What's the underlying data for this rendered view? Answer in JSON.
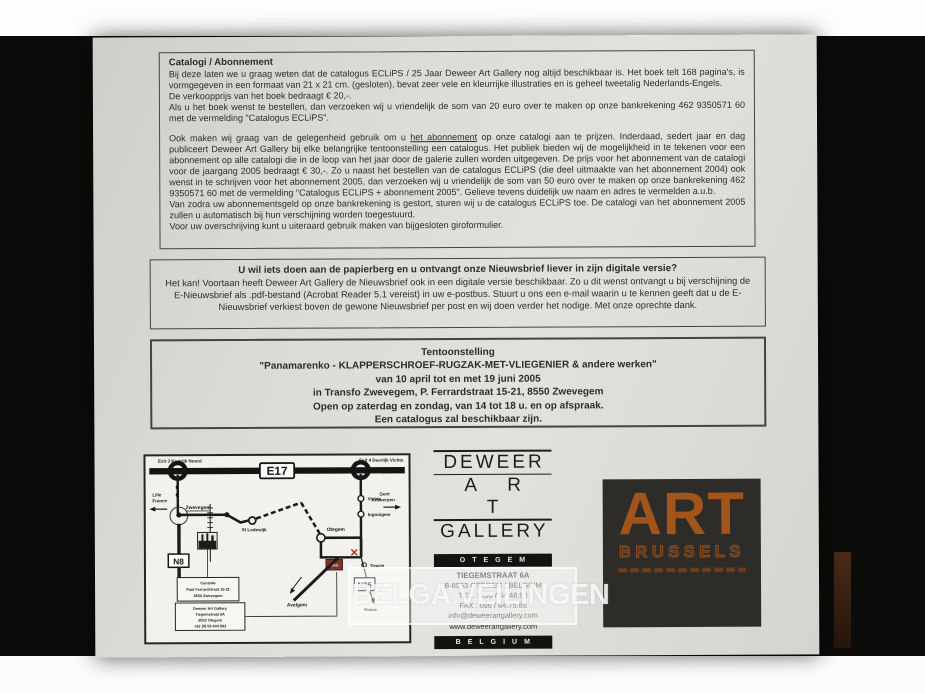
{
  "box1": {
    "heading": "Catalogi / Abonnement",
    "p1_line1": "Bij deze laten we u graag weten dat de catalogus ECLiPS / 25 Jaar Deweer Art Gallery nog altijd beschikbaar is. Het boek telt 168 pagina's, is vormgegeven in een formaat van 21 x 21 cm. (gesloten), bevat zeer vele en kleurrijke illustraties en is geheel tweetalig Nederlands-Engels.",
    "p1_line2": "De verkoopprijs van het boek bedraagt € 20,-.",
    "p1_line3": "Als u het boek wenst te bestellen, dan verzoeken wij u vriendelijk de som van 20 euro over te maken op onze bankrekening 462 9350571 60 met de vermelding \"Catalogus ECLiPS\".",
    "p2_pre": "Ook maken wij graag van de gelegenheid gebruik om u ",
    "p2_underline": "het abonnement",
    "p2_post": " op onze catalogi aan te prijzen. Inderdaad, sedert jaar en dag publiceert Deweer Art Gallery bij elke belangrijke tentoonstelling een catalogus. Het publiek bieden wij de mogelijkheid in te tekenen voor een abonnement op alle catalogi die in de loop van het jaar door de galerie zullen worden uitgegeven. De prijs voor het abonnement van de catalogi voor de jaargang 2005 bedraagt € 30,-. Zo u naast het bestellen van de catalogus ECLiPS (die deel uitmaakte van het abonnement 2004) ook wenst in te schrijven voor het abonnement 2005, dan verzoeken wij u vriendelijk de som van 50 euro over te maken op onze bankrekening 462 9350571 60 met de vermelding \"Catalogus ECLiPS + abonnement 2005\". Gelieve tevens duidelijk uw naam en adres te vermelden a.u.b.",
    "p2_line2": "Van zodra uw abonnementsgeld op onze bankrekening is gestort, sturen wij u de catalogus ECLiPS toe. De catalogi van het abonnement 2005 zullen u automatisch bij hun verschijning worden toegestuurd.",
    "p2_line3": "Voor uw overschrijving kunt u uiteraard gebruik maken van bijgesloten giroformulier."
  },
  "box2": {
    "heading": "U wil iets doen aan de papierberg en u ontvangt onze Nieuwsbrief liever in zijn digitale versie?",
    "body": "Het kan! Voortaan heeft Deweer Art Gallery de Nieuwsbrief ook in een digitale versie beschikbaar. Zo u dit wenst ontvangt u bij verschijning de E-Nieuwsbrief als .pdf-bestand (Acrobat Reader 5.1 vereist) in uw e-postbus. Stuurt u ons een e-mail waarin u te kennen geeft dat u de E-Nieuwsbrief verkiest boven de gewone Nieuwsbrief per post en wij doen verder het nodige. Met onze oprechte dank."
  },
  "box3": {
    "line1": "Tentoonstelling",
    "line2": "\"Panamarenko - KLAPPERSCHROEF-RUGZAK-MET-VLIEGENIER & andere werken\"",
    "line3": "van 10 april tot en met 19 juni 2005",
    "line4": "in Transfo Zwevegem, P. Ferrardstraat 15-21, 8550 Zwevegem",
    "line5": "Open op zaterdag en zondag, van 14 tot 18 u. en op afspraak.",
    "line6": "Een catalogus zal beschikbaar zijn."
  },
  "map": {
    "exit3": "Exit 3 Kortrijk Noord",
    "exit4": "Exit 4 Deerlijk Vichte",
    "e17": "E17",
    "lille1": "Lille",
    "lille2": "France",
    "gent1": "Gent",
    "gent2": "Antwerpen",
    "zwevegem": "Zwevegem",
    "vichte": "Vichte",
    "ingooigem": "Ingooigem",
    "stlodewijk": "St Lodewijk",
    "otegem": "Otegem",
    "avelgem": "Avelgem",
    "tiegem": "Tiegem",
    "ronse": "Ronse",
    "n8": "N8",
    "n36": "N36",
    "dag": "DAG",
    "centrale1": "Centrale",
    "centrale2": "Paul Ferrardstraat 15-21",
    "centrale3": "8550 Zwevegem",
    "gallery1": "Deweer Art Gallery",
    "gallery2": "Tiegemstraat 6A",
    "gallery3": "8553 Otegem",
    "gallery4": "+32 (0) 56 644 893"
  },
  "deweer": {
    "name1": "DEWEER",
    "name2": "A R T",
    "name3": "GALLERY",
    "bar1": "OTEGEM",
    "addr1": "TIEGEMSTRAAT 6A",
    "addr2": "B-8553 OTEGEM / BELGIUM",
    "addr3": "TEL. : 056 / 64.48.93",
    "addr4": "FAX : 056 / 64.75.85",
    "addr5": "info@deweerartgallery.com",
    "addr6": "www.deweerartgallery.com",
    "bar2": "BELGIUM"
  },
  "artbrussels": {
    "title": "ART",
    "subtitle": "BRUSSELS"
  },
  "watermark": {
    "text": "BELGA VEILINGEN"
  },
  "colors": {
    "paper": "#dbdad6",
    "accent_orange": "#a2541b",
    "marker_red": "#7c352b"
  }
}
